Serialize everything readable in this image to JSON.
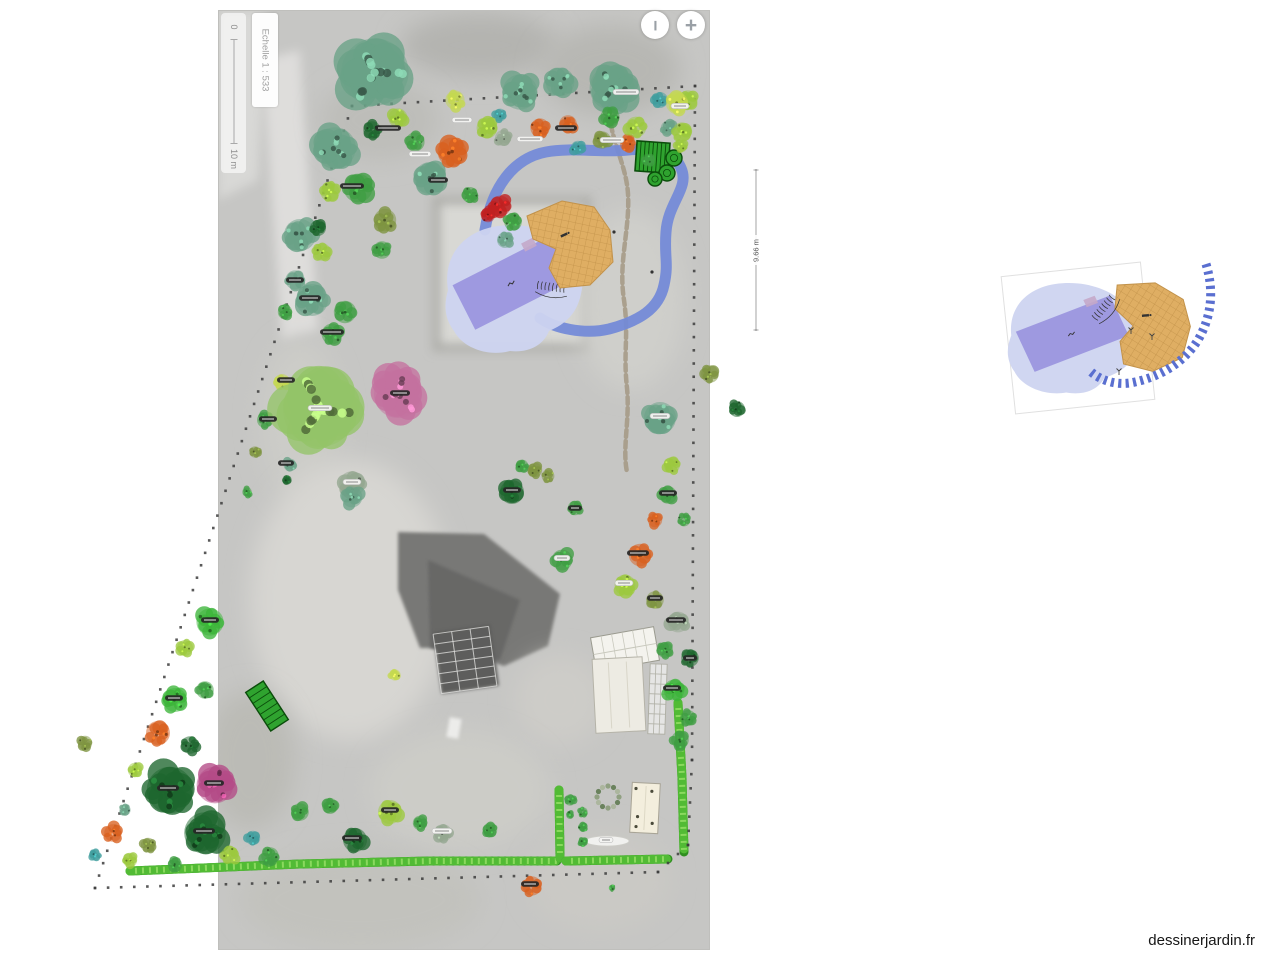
{
  "watermark": {
    "text": "dessinerjardin.fr"
  },
  "scalebar": {
    "top_label": "0",
    "bottom_label": "10 m",
    "scale_label": "Echelle 1 : 533"
  },
  "zoom_controls": {
    "zoom_out_symbol": "−",
    "zoom_in_symbol": "+"
  },
  "measurement": {
    "label": "9.66 m",
    "x": 756,
    "y1": 170,
    "y2": 330
  },
  "palette": {
    "teal": "#69a287",
    "darkgreen": "#1e672e",
    "green": "#3f9e42",
    "bright": "#3cb53a",
    "lime": "#9cc93e",
    "yellowgreen": "#c4d84e",
    "olive": "#7d9440",
    "orange": "#d8601f",
    "red": "#c02020",
    "pink": "#c4719f",
    "magenta": "#b34a86",
    "graygreen": "#93a68f",
    "cyan": "#3f9e9e",
    "willow": "#94c468"
  },
  "colors": {
    "pond": "#cdd4f0",
    "pool": "#9e99e0",
    "pool_tab": "#c4a9c9",
    "deck": "#dfae63",
    "deck_line": "#c2924a",
    "ribbon": "#7289d8",
    "ribbon_dash": "#5a6fd0",
    "hedge_dark": "#2f8f20",
    "hedge_mid": "#52bb35",
    "hedge_light": "#8ad95e",
    "boundary": "#3c3c3c",
    "structure_green": "#2fa32f",
    "structure_green_dark": "#0b4d0b",
    "gravel": "#a39884"
  },
  "plan": {
    "photo": {
      "x": 218,
      "y": 10,
      "w": 492,
      "h": 940,
      "base": "#c6c6c4",
      "border": "#bfbfbc",
      "patches": [
        {
          "k": "p",
          "pts": [
            [
              218,
              10
            ],
            [
              268,
              10
            ],
            [
              258,
              180
            ],
            [
              218,
              200
            ]
          ],
          "f": "#d8d8d6",
          "b": 2
        },
        {
          "k": "p",
          "pts": [
            [
              262,
              60
            ],
            [
              300,
              50
            ],
            [
              318,
              330
            ],
            [
              282,
              340
            ]
          ],
          "f": "#dedddb",
          "b": 2
        },
        {
          "k": "e",
          "cx": 480,
          "cy": 45,
          "rx": 80,
          "ry": 32,
          "f": "#b4b4b0",
          "b": 3
        },
        {
          "k": "e",
          "cx": 610,
          "cy": 70,
          "rx": 70,
          "ry": 45,
          "f": "#b7b7b3",
          "b": 3
        },
        {
          "k": "e",
          "cx": 380,
          "cy": 120,
          "rx": 60,
          "ry": 40,
          "f": "#bdbdb9",
          "b": 3
        },
        {
          "k": "r",
          "x": 436,
          "y": 200,
          "w": 152,
          "h": 148,
          "f": "#d8d8d4",
          "b": 2
        },
        {
          "k": "r",
          "x": 436,
          "y": 200,
          "w": 152,
          "h": 148,
          "f": "none",
          "s": "#a9a9a4",
          "sw": 7,
          "b": 2
        },
        {
          "k": "e",
          "cx": 630,
          "cy": 300,
          "rx": 55,
          "ry": 90,
          "f": "#cfcfcb",
          "b": 3
        },
        {
          "k": "e",
          "cx": 300,
          "cy": 420,
          "rx": 40,
          "ry": 80,
          "f": "#ccccc8",
          "b": 3
        },
        {
          "k": "e",
          "cx": 350,
          "cy": 600,
          "rx": 100,
          "ry": 140,
          "f": "#d7d6d2",
          "b": 3
        },
        {
          "k": "e",
          "cx": 250,
          "cy": 760,
          "rx": 45,
          "ry": 70,
          "f": "#bbbbb6",
          "b": 3
        },
        {
          "k": "p",
          "pts": [
            [
              398,
              532
            ],
            [
              484,
              534
            ],
            [
              560,
              594
            ],
            [
              548,
              646
            ],
            [
              504,
              666
            ],
            [
              452,
              648
            ],
            [
              420,
              648
            ],
            [
              398,
              590
            ]
          ],
          "f": "#787876",
          "b": 1
        },
        {
          "k": "p",
          "pts": [
            [
              428,
              560
            ],
            [
              520,
              600
            ],
            [
              500,
              660
            ],
            [
              430,
              648
            ]
          ],
          "f": "#686866",
          "b": 1
        },
        {
          "k": "r",
          "x": 437,
          "y": 628,
          "w": 58,
          "h": 62,
          "f": "#5d5d5b",
          "b": 1,
          "rot": -8
        },
        {
          "k": "e",
          "cx": 560,
          "cy": 700,
          "rx": 45,
          "ry": 45,
          "f": "#cdccc8",
          "b": 3
        },
        {
          "k": "e",
          "cx": 460,
          "cy": 790,
          "rx": 90,
          "ry": 60,
          "f": "#ccccc7",
          "b": 3
        },
        {
          "k": "e",
          "cx": 360,
          "cy": 900,
          "rx": 120,
          "ry": 50,
          "f": "#c2c2bd",
          "b": 3
        },
        {
          "k": "e",
          "cx": 600,
          "cy": 880,
          "rx": 70,
          "ry": 50,
          "f": "#cac9c5",
          "b": 3
        },
        {
          "k": "r",
          "x": 448,
          "y": 718,
          "w": 12,
          "h": 20,
          "f": "#ececea",
          "b": 1,
          "rot": 10
        }
      ]
    },
    "gravel_path": "M 612,92 C 602,128 626,158 628,194 C 630,230 618,262 624,300 C 629,336 623,352 627,388 C 630,420 622,448 627,472",
    "ribbon_path": "M 485,230 C 492,186 514,158 546,152 C 572,147 600,153 628,150 C 652,148 674,151 681,168 C 690,188 668,202 666,232 C 664,257 669,263 664,285 C 659,309 639,321 609,329 C 584,335 554,328 540,318",
    "pond_path": "M 448,290 C 442,252 468,230 498,226 C 524,222 548,230 562,242 C 580,253 586,272 581,294 C 577,313 566,324 549,331 C 543,346 528,353 510,351 C 488,357 463,348 454,331 C 444,318 444,304 448,290 Z",
    "pool": {
      "cx": 512,
      "cy": 283,
      "w": 108,
      "h": 50,
      "rot": -27
    },
    "deck_points": "527,216 562,201 594,207 610,230 613,262 590,285 560,288 549,268 556,249 533,239",
    "deck_glyph": {
      "x": 564,
      "y": 235
    },
    "steps": {
      "x": 552,
      "y": 287,
      "rot": 8
    },
    "marks": [
      [
        614,
        232
      ],
      [
        652,
        272
      ]
    ],
    "veg": {
      "x": 636,
      "y": 142,
      "w": 33,
      "h": 30,
      "rot": 4
    },
    "planters": [
      [
        674,
        158,
        8
      ],
      [
        667,
        173,
        8
      ],
      [
        655,
        179,
        7
      ]
    ],
    "pergola": {
      "cx": 267,
      "cy": 706,
      "w": 21,
      "h": 46,
      "rot": -33
    },
    "greenhouse": {
      "cx": 625,
      "cy": 649,
      "w": 64,
      "h": 34,
      "rot": -10
    },
    "shed": {
      "x": 594,
      "y": 658,
      "w": 50,
      "h": 74,
      "rot": -3
    },
    "trellis": {
      "x": 649,
      "y": 664,
      "w": 17,
      "h": 70,
      "rot": 2
    },
    "table": {
      "x": 631,
      "y": 783,
      "w": 28,
      "h": 50,
      "rot": 3
    },
    "wreath": {
      "cx": 608,
      "cy": 797,
      "r": 11
    },
    "oval_label": {
      "cx": 607,
      "cy": 841,
      "rx": 22,
      "ry": 5
    },
    "solar": {
      "x": 437,
      "y": 630,
      "w": 56,
      "h": 60,
      "rot": -8
    },
    "hedges": [
      "M 130,871 L 300,864 L 430,861 L 557,861",
      "M 559,790 L 560,858",
      "M 566,861 L 668,859",
      "M 678,703 L 682,778 L 684,852"
    ],
    "boundary_points": [
      [
        352,
        106
      ],
      [
        695,
        86
      ],
      [
        692,
        760
      ],
      [
        688,
        845
      ],
      [
        658,
        872
      ],
      [
        95,
        888
      ]
    ],
    "plants": [
      [
        375,
        72,
        42,
        "teal"
      ],
      [
        335,
        148,
        26,
        "teal"
      ],
      [
        300,
        235,
        20,
        "teal"
      ],
      [
        312,
        300,
        20,
        "teal"
      ],
      [
        345,
        312,
        14,
        "green"
      ],
      [
        430,
        178,
        20,
        "teal"
      ],
      [
        358,
        188,
        18,
        "green"
      ],
      [
        520,
        92,
        22,
        "teal"
      ],
      [
        560,
        82,
        18,
        "teal"
      ],
      [
        612,
        88,
        28,
        "teal"
      ],
      [
        660,
        100,
        10,
        "cyan"
      ],
      [
        688,
        100,
        12,
        "lime"
      ],
      [
        668,
        128,
        9,
        "teal"
      ],
      [
        398,
        118,
        12,
        "lime"
      ],
      [
        372,
        130,
        11,
        "darkgreen"
      ],
      [
        415,
        142,
        12,
        "green"
      ],
      [
        452,
        152,
        18,
        "orange"
      ],
      [
        455,
        100,
        12,
        "yellowgreen"
      ],
      [
        487,
        128,
        13,
        "lime"
      ],
      [
        503,
        138,
        10,
        "graygreen"
      ],
      [
        540,
        128,
        12,
        "orange"
      ],
      [
        568,
        124,
        11,
        "orange"
      ],
      [
        578,
        148,
        9,
        "cyan"
      ],
      [
        602,
        140,
        11,
        "olive"
      ],
      [
        628,
        144,
        10,
        "orange"
      ],
      [
        648,
        160,
        8,
        "green"
      ],
      [
        500,
        115,
        8,
        "cyan"
      ],
      [
        610,
        117,
        12,
        "green"
      ],
      [
        636,
        127,
        13,
        "lime"
      ],
      [
        322,
        252,
        11,
        "lime"
      ],
      [
        330,
        192,
        12,
        "lime"
      ],
      [
        318,
        228,
        10,
        "darkgreen"
      ],
      [
        295,
        280,
        12,
        "teal"
      ],
      [
        285,
        312,
        9,
        "green"
      ],
      [
        332,
        334,
        13,
        "green"
      ],
      [
        282,
        382,
        10,
        "yellowgreen"
      ],
      [
        265,
        420,
        10,
        "green"
      ],
      [
        290,
        465,
        8,
        "teal"
      ],
      [
        255,
        452,
        7,
        "olive"
      ],
      [
        247,
        492,
        6,
        "green"
      ],
      [
        385,
        220,
        14,
        "olive"
      ],
      [
        382,
        250,
        11,
        "green"
      ],
      [
        320,
        410,
        46,
        "willow"
      ],
      [
        398,
        394,
        30,
        "pink"
      ],
      [
        352,
        484,
        16,
        "graygreen"
      ],
      [
        352,
        497,
        13,
        "teal"
      ],
      [
        287,
        480,
        6,
        "darkgreen"
      ],
      [
        500,
        206,
        13,
        "red"
      ],
      [
        488,
        215,
        9,
        "red"
      ],
      [
        513,
        222,
        11,
        "green"
      ],
      [
        505,
        240,
        10,
        "teal"
      ],
      [
        470,
        195,
        10,
        "green"
      ],
      [
        660,
        418,
        20,
        "teal"
      ],
      [
        672,
        465,
        10,
        "lime"
      ],
      [
        668,
        495,
        11,
        "green"
      ],
      [
        655,
        520,
        9,
        "orange"
      ],
      [
        684,
        520,
        8,
        "green"
      ],
      [
        640,
        555,
        14,
        "orange"
      ],
      [
        625,
        585,
        13,
        "lime"
      ],
      [
        655,
        600,
        11,
        "olive"
      ],
      [
        678,
        622,
        13,
        "graygreen"
      ],
      [
        665,
        650,
        10,
        "green"
      ],
      [
        690,
        658,
        11,
        "darkgreen"
      ],
      [
        674,
        690,
        13,
        "bright"
      ],
      [
        688,
        718,
        10,
        "green"
      ],
      [
        680,
        740,
        11,
        "green"
      ],
      [
        710,
        374,
        11,
        "olive"
      ],
      [
        737,
        409,
        10,
        "darkgreen"
      ],
      [
        677,
        103,
        14,
        "yellowgreen"
      ],
      [
        682,
        132,
        12,
        "lime"
      ],
      [
        681,
        146,
        8,
        "lime"
      ],
      [
        512,
        492,
        15,
        "darkgreen"
      ],
      [
        535,
        470,
        9,
        "olive"
      ],
      [
        522,
        466,
        8,
        "green"
      ],
      [
        548,
        476,
        8,
        "olive"
      ],
      [
        575,
        508,
        9,
        "green"
      ],
      [
        562,
        560,
        13,
        "green"
      ],
      [
        210,
        622,
        17,
        "bright"
      ],
      [
        185,
        648,
        10,
        "lime"
      ],
      [
        175,
        700,
        15,
        "bright"
      ],
      [
        205,
        690,
        11,
        "green"
      ],
      [
        158,
        733,
        15,
        "orange"
      ],
      [
        190,
        745,
        11,
        "darkgreen"
      ],
      [
        85,
        743,
        9,
        "olive"
      ],
      [
        135,
        770,
        9,
        "lime"
      ],
      [
        215,
        785,
        23,
        "magenta"
      ],
      [
        170,
        790,
        29,
        "darkgreen"
      ],
      [
        125,
        810,
        7,
        "teal"
      ],
      [
        113,
        833,
        11,
        "orange"
      ],
      [
        148,
        845,
        9,
        "olive"
      ],
      [
        205,
        833,
        26,
        "darkgreen"
      ],
      [
        130,
        860,
        9,
        "lime"
      ],
      [
        95,
        855,
        7,
        "cyan"
      ],
      [
        175,
        865,
        9,
        "green"
      ],
      [
        230,
        855,
        11,
        "lime"
      ],
      [
        253,
        838,
        9,
        "cyan"
      ],
      [
        270,
        856,
        11,
        "green"
      ],
      [
        300,
        812,
        11,
        "green"
      ],
      [
        330,
        806,
        10,
        "green"
      ],
      [
        355,
        840,
        15,
        "darkgreen"
      ],
      [
        390,
        812,
        15,
        "lime"
      ],
      [
        420,
        823,
        9,
        "green"
      ],
      [
        443,
        833,
        11,
        "graygreen"
      ],
      [
        490,
        830,
        9,
        "green"
      ],
      [
        532,
        886,
        12,
        "orange"
      ],
      [
        395,
        675,
        7,
        "yellowgreen"
      ],
      [
        612,
        888,
        4,
        "green"
      ],
      [
        570,
        800,
        7,
        "green"
      ],
      [
        583,
        812,
        6,
        "green"
      ],
      [
        583,
        827,
        6,
        "green"
      ],
      [
        583,
        842,
        6,
        "green"
      ],
      [
        570,
        815,
        5,
        "green"
      ]
    ],
    "labels": [
      [
        388,
        128,
        26,
        "d"
      ],
      [
        420,
        154,
        22,
        "l"
      ],
      [
        352,
        186,
        24,
        "d"
      ],
      [
        310,
        298,
        22,
        "d"
      ],
      [
        332,
        332,
        24,
        "d"
      ],
      [
        286,
        380,
        18,
        "d"
      ],
      [
        268,
        419,
        18,
        "d"
      ],
      [
        462,
        120,
        20,
        "l"
      ],
      [
        530,
        139,
        26,
        "l"
      ],
      [
        566,
        128,
        22,
        "d"
      ],
      [
        612,
        140,
        24,
        "l"
      ],
      [
        626,
        92,
        26,
        "l"
      ],
      [
        680,
        106,
        18,
        "l"
      ],
      [
        438,
        180,
        20,
        "d"
      ],
      [
        320,
        408,
        24,
        "l"
      ],
      [
        400,
        393,
        20,
        "d"
      ],
      [
        286,
        463,
        16,
        "d"
      ],
      [
        352,
        482,
        18,
        "l"
      ],
      [
        660,
        416,
        20,
        "l"
      ],
      [
        668,
        493,
        18,
        "d"
      ],
      [
        638,
        553,
        22,
        "d"
      ],
      [
        624,
        583,
        18,
        "l"
      ],
      [
        676,
        620,
        20,
        "d"
      ],
      [
        672,
        688,
        18,
        "d"
      ],
      [
        210,
        620,
        18,
        "d"
      ],
      [
        174,
        698,
        18,
        "d"
      ],
      [
        214,
        783,
        20,
        "d"
      ],
      [
        168,
        788,
        22,
        "d"
      ],
      [
        204,
        831,
        22,
        "d"
      ],
      [
        352,
        838,
        20,
        "d"
      ],
      [
        390,
        810,
        18,
        "d"
      ],
      [
        442,
        831,
        20,
        "l"
      ],
      [
        530,
        884,
        18,
        "d"
      ],
      [
        606,
        840,
        14,
        "l"
      ],
      [
        575,
        508,
        14,
        "d"
      ],
      [
        562,
        558,
        16,
        "l"
      ],
      [
        512,
        490,
        18,
        "d"
      ],
      [
        295,
        280,
        18,
        "d"
      ],
      [
        655,
        598,
        16,
        "d"
      ],
      [
        690,
        658,
        14,
        "d"
      ]
    ]
  },
  "inset": {
    "frame": {
      "cx": 1078,
      "cy": 338,
      "w": 140,
      "h": 138,
      "rot": -6
    },
    "pond_transform": "translate(1072,338) rotate(4) scale(0.95,0.87) translate(-512,-288)",
    "deck_transform": "translate(1148,326) rotate(20) translate(-570,-244)",
    "steps": {
      "x": 1104,
      "y": 307,
      "rot": -50
    },
    "dash_path": "M 1206,264 C 1214,290 1212,316 1198,340 C 1183,364 1158,378 1130,383 C 1114,385 1100,380 1090,371",
    "sprouts": [
      [
        1152,
        337
      ],
      [
        1119,
        372
      ],
      [
        1131,
        331
      ]
    ]
  }
}
